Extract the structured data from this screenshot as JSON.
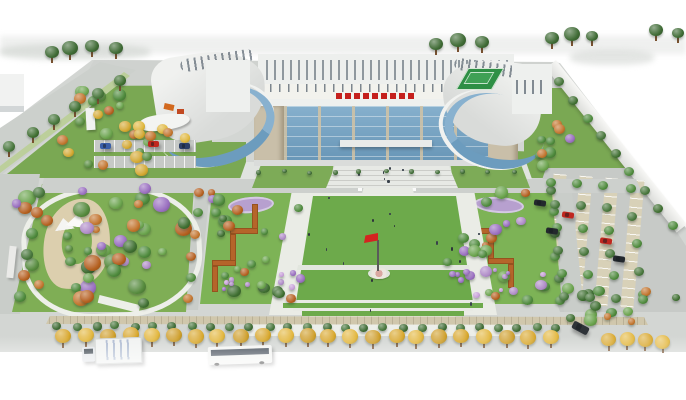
{
  "meta": {
    "alt": "Aerial architectural rendering of a civic office complex: central building with blue glass curtain wall and red rooftop signage, two curved glass wing buildings, central lawn plaza with red flag, flanking gardens with purple pavements and terracotta stepped paths, west park with sandy winding stream and white canopy pavilion, east tree-lined parking lot behind a white perimeter wall, and a front road with yellow street trees, a bus and a box truck."
  },
  "palette": {
    "page_bg": "#ffffff",
    "road": "#cdd0cd",
    "lawn": "#7bae53",
    "plaza_lawn": "#6daa4b",
    "path_white": "#eaece6",
    "sand": "#dccfae",
    "glass_blue": "#74a2c2",
    "facade_beige": "#c9bfa9",
    "roof_white": "#eef0ee",
    "sign_red": "#c5201d",
    "flag_red": "#d42420",
    "tree_green": "#4e8a3c",
    "tree_yellow": "#d9a92c",
    "tree_orange": "#b5611f",
    "tree_purple": "#b08cc8",
    "terracotta_path": "#b5652a",
    "purple_pavement": "#b7a0cf",
    "wall_white": "#f6f6f4"
  },
  "scene": {
    "clusters": [
      {
        "name": "park-trees",
        "x": 16,
        "y": 188,
        "w": 172,
        "h": 118,
        "count": 46,
        "rmin": 4,
        "rmax": 9,
        "seed": 11,
        "colors": [
          "#4e8a3c",
          "#3f6f31",
          "#b08cc8",
          "#b5611f",
          "#6aa34c",
          "#c2752c",
          "#9a6fc0",
          "#578b3e"
        ]
      },
      {
        "name": "upper-left-trees",
        "x": 58,
        "y": 90,
        "w": 148,
        "h": 84,
        "count": 20,
        "rmin": 4,
        "rmax": 7,
        "seed": 12,
        "colors": [
          "#4e8a3c",
          "#d4a930",
          "#c2752c",
          "#6aa34c",
          "#b5611f",
          "#578b3e"
        ]
      },
      {
        "name": "left-garden-trees",
        "x": 208,
        "y": 192,
        "w": 100,
        "h": 110,
        "count": 24,
        "rmin": 3.5,
        "rmax": 7,
        "seed": 13,
        "colors": [
          "#4e8a3c",
          "#b08cc8",
          "#b5611f",
          "#6aa34c",
          "#3f6f31",
          "#9a6fc0"
        ]
      },
      {
        "name": "right-garden-trees",
        "x": 442,
        "y": 192,
        "w": 110,
        "h": 108,
        "count": 24,
        "rmin": 3.5,
        "rmax": 7,
        "seed": 14,
        "colors": [
          "#4e8a3c",
          "#b08cc8",
          "#b5611f",
          "#6aa34c",
          "#3f6f31",
          "#9a6fc0"
        ]
      },
      {
        "name": "behind-right-trees",
        "x": 538,
        "y": 122,
        "w": 54,
        "h": 46,
        "count": 9,
        "rmin": 3.5,
        "rmax": 6,
        "seed": 15,
        "colors": [
          "#c2752c",
          "#4e8a3c",
          "#9a6fc0",
          "#6aa34c"
        ]
      },
      {
        "name": "yellow-row-left-wing",
        "x": 112,
        "y": 126,
        "w": 80,
        "h": 20,
        "count": 9,
        "rmin": 4,
        "rmax": 6,
        "seed": 16,
        "colors": [
          "#d4a930",
          "#e0b83c",
          "#c2752c"
        ]
      },
      {
        "name": "se-shrubs",
        "x": 560,
        "y": 286,
        "w": 122,
        "h": 42,
        "count": 16,
        "rmin": 3.5,
        "rmax": 6.5,
        "seed": 17,
        "colors": [
          "#4e8a3c",
          "#6aa34c",
          "#3f6f31",
          "#c2752c"
        ]
      },
      {
        "name": "left-flower-bed",
        "x": 215,
        "y": 266,
        "w": 82,
        "h": 30,
        "count": 9,
        "rmin": 2,
        "rmax": 3.5,
        "seed": 18,
        "colors": [
          "#b08cc8",
          "#c79fd8",
          "#9a6fc0"
        ]
      },
      {
        "name": "right-flower-bed",
        "x": 452,
        "y": 264,
        "w": 92,
        "h": 32,
        "count": 10,
        "rmin": 2,
        "rmax": 3.5,
        "seed": 19,
        "colors": [
          "#b08cc8",
          "#c79fd8",
          "#9a6fc0"
        ]
      },
      {
        "name": "plaza-people",
        "x": 288,
        "y": 196,
        "w": 196,
        "h": 118,
        "count": 14,
        "rmin": 1,
        "rmax": 1.6,
        "seed": 20,
        "colors": [
          "#38404a",
          "#2d333b"
        ],
        "shape": "dot"
      },
      {
        "name": "entrance-people",
        "x": 336,
        "y": 162,
        "w": 108,
        "h": 20,
        "count": 6,
        "rmin": 1,
        "rmax": 1.5,
        "seed": 21,
        "colors": [
          "#38404a"
        ],
        "shape": "dot"
      }
    ],
    "rows": [
      {
        "name": "street-hedge",
        "x0": 58,
        "y0": 326,
        "x1": 556,
        "y1": 328,
        "count": 27,
        "r": 4.5,
        "colors": [
          "#3e6b34",
          "#47763b"
        ]
      },
      {
        "name": "street-trees-yellow",
        "x0": 64,
        "y0": 335,
        "x1": 550,
        "y1": 337,
        "count": 23,
        "r": 8,
        "colors": [
          "#d9a92c",
          "#e3b83e",
          "#cfa02a"
        ],
        "trunk": true
      },
      {
        "name": "street-trees-yellow-right",
        "x0": 608,
        "y0": 339,
        "x1": 664,
        "y1": 341,
        "count": 4,
        "r": 7.5,
        "colors": [
          "#d9a92c",
          "#e3b83e"
        ],
        "trunk": true
      },
      {
        "name": "left-road-trees",
        "x0": 10,
        "y0": 146,
        "x1": 120,
        "y1": 80,
        "count": 6,
        "r": 6,
        "colors": [
          "#47763b",
          "#3f6f31"
        ],
        "trunk": true
      },
      {
        "name": "west-road-trees",
        "x0": 40,
        "y0": 192,
        "x1": 20,
        "y1": 296,
        "count": 6,
        "r": 6,
        "colors": [
          "#47763b",
          "#b5611f",
          "#4e8a3c"
        ]
      },
      {
        "name": "park-edge-trees",
        "x0": 200,
        "y0": 192,
        "x1": 188,
        "y1": 298,
        "count": 6,
        "r": 5,
        "colors": [
          "#b5611f",
          "#4e8a3c",
          "#c2752c"
        ]
      },
      {
        "name": "east-lane-trees",
        "x0": 552,
        "y0": 190,
        "x1": 560,
        "y1": 300,
        "count": 6,
        "r": 5,
        "colors": [
          "#47763b",
          "#4e8a3c"
        ]
      },
      {
        "name": "wall-hedge-trees",
        "x0": 560,
        "y0": 82,
        "x1": 672,
        "y1": 226,
        "count": 9,
        "r": 5,
        "colors": [
          "#47763b",
          "#3f6f31",
          "#4e8a3c"
        ]
      },
      {
        "name": "front-hedge",
        "x0": 258,
        "y0": 172,
        "x1": 514,
        "y1": 172,
        "count": 11,
        "r": 2.5,
        "colors": [
          "#3e6b34"
        ]
      },
      {
        "name": "pstrip-trees-1",
        "x0": 552,
        "y0": 182,
        "x1": 564,
        "y1": 296,
        "count": 6,
        "r": 5,
        "colors": [
          "#4e8a3c",
          "#47763b"
        ]
      },
      {
        "name": "pstrip-trees-2",
        "x0": 578,
        "y0": 183,
        "x1": 590,
        "y1": 297,
        "count": 6,
        "r": 5,
        "colors": [
          "#4e8a3c",
          "#47763b"
        ]
      },
      {
        "name": "pstrip-trees-3",
        "x0": 604,
        "y0": 185,
        "x1": 616,
        "y1": 298,
        "count": 6,
        "r": 5,
        "colors": [
          "#4e8a3c",
          "#47763b"
        ]
      },
      {
        "name": "pstrip-trees-4",
        "x0": 630,
        "y0": 188,
        "x1": 642,
        "y1": 300,
        "count": 5,
        "r": 5,
        "colors": [
          "#4e8a3c",
          "#47763b"
        ]
      }
    ],
    "conifers": {
      "color": "#3f6b35",
      "points": [
        [
          52,
          52,
          7
        ],
        [
          70,
          48,
          8
        ],
        [
          92,
          46,
          7
        ],
        [
          116,
          48,
          7
        ],
        [
          436,
          44,
          7
        ],
        [
          458,
          40,
          8
        ],
        [
          482,
          42,
          7
        ],
        [
          552,
          38,
          7
        ],
        [
          572,
          34,
          8
        ],
        [
          592,
          36,
          6
        ],
        [
          656,
          30,
          7
        ],
        [
          678,
          33,
          6
        ]
      ]
    },
    "vehicles": [
      {
        "kind": "truck",
        "name": "box-truck",
        "x": 82,
        "y": 336,
        "angle": -2
      },
      {
        "kind": "bus",
        "name": "city-bus",
        "x": 208,
        "y": 346,
        "angle": -2
      },
      {
        "kind": "car",
        "name": "car-dark-se",
        "x": 572,
        "y": 324,
        "w": 17,
        "h": 8,
        "angle": 28,
        "color": "#2e3338"
      },
      {
        "kind": "car",
        "name": "car-blue",
        "x": 100,
        "y": 143,
        "w": 11,
        "h": 6,
        "angle": 0,
        "color": "#3a5fa8"
      },
      {
        "kind": "car",
        "name": "car-red",
        "x": 148,
        "y": 141,
        "w": 11,
        "h": 6,
        "angle": 0,
        "color": "#c0271f"
      },
      {
        "kind": "car",
        "name": "car-navy",
        "x": 179,
        "y": 143,
        "w": 11,
        "h": 6,
        "angle": 0,
        "color": "#2c3e66"
      },
      {
        "kind": "car",
        "name": "car-p1",
        "x": 534,
        "y": 200,
        "w": 12,
        "h": 6,
        "angle": 8,
        "color": "#23282d"
      },
      {
        "kind": "car",
        "name": "car-p2",
        "x": 562,
        "y": 212,
        "w": 12,
        "h": 6,
        "angle": 8,
        "color": "#c0271f"
      },
      {
        "kind": "car",
        "name": "car-p3",
        "x": 546,
        "y": 228,
        "w": 12,
        "h": 6,
        "angle": 8,
        "color": "#23282d"
      },
      {
        "kind": "car",
        "name": "car-p4",
        "x": 600,
        "y": 238,
        "w": 12,
        "h": 6,
        "angle": 8,
        "color": "#c0271f"
      },
      {
        "kind": "car",
        "name": "car-p5",
        "x": 613,
        "y": 256,
        "w": 12,
        "h": 6,
        "angle": 8,
        "color": "#23282d"
      }
    ]
  }
}
